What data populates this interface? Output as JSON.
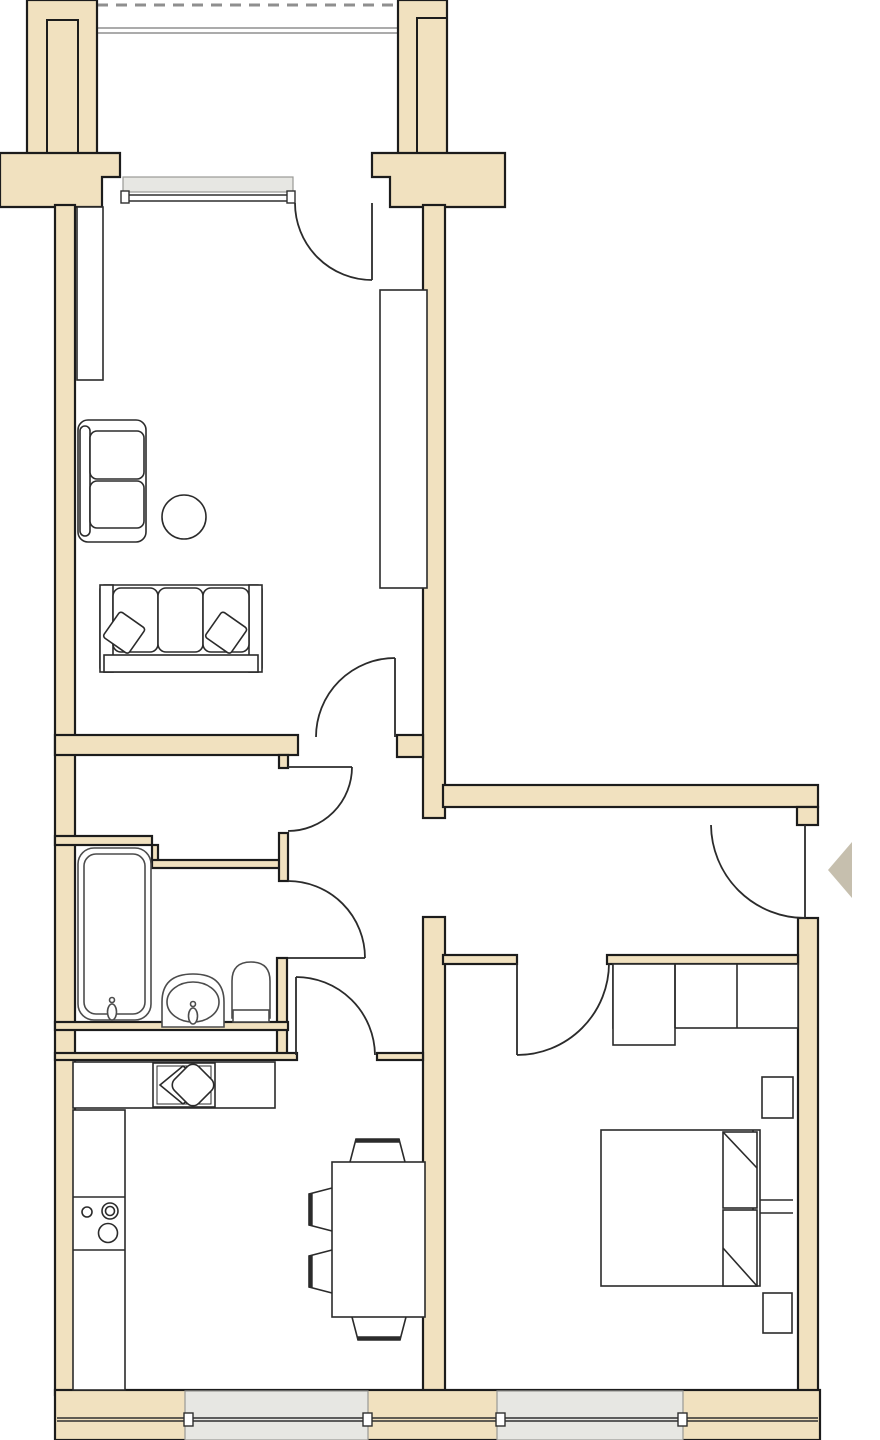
{
  "page": {
    "title": "apartment-floor-plan",
    "description": "architectural floor plan drawing, no text labels"
  },
  "colors": {
    "background": "#ffffff",
    "wall_fill": "#f1e1bf",
    "wall_outline": "#1c1c1c",
    "wall_inner_line": "#1c1c1c",
    "window_fill": "#e7e7e3",
    "window_stroke": "#9a9a96",
    "glazing_stroke": "#2f2f2f",
    "balcony_stroke": "#8f8f8f",
    "door_stroke": "#2b2b2b",
    "fixture_stroke": "#4c4c4c",
    "furniture_stroke": "#2b2b2b",
    "furniture_fill": "#ffffff",
    "entry_arrow_fill": "#c6bfae"
  },
  "rooms": {
    "balcony": {
      "features": [
        "dashed-edge-line",
        "railing-double-line"
      ]
    },
    "living_room": {
      "furniture": [
        "tall-cabinet",
        "loveseat",
        "round-side-table",
        "sofa-3-seat",
        "throw-pillow",
        "throw-pillow",
        "wardrobe"
      ]
    },
    "hall": {
      "features": [
        "inner-door",
        "open-passage"
      ]
    },
    "bathroom": {
      "fixtures": [
        "bathtub",
        "wash-basin",
        "toilet",
        "installation-shaft"
      ]
    },
    "kitchen_dining": {
      "furniture": [
        "counter-top",
        "kitchen-sink-unit",
        "stove-with-burners",
        "tall-counter-run",
        "dining-table",
        "chair",
        "chair",
        "chair",
        "chair"
      ]
    },
    "bedroom": {
      "furniture": [
        "closet-3-sections",
        "nightstand",
        "nightstand",
        "double-bed",
        "pillow",
        "pillow",
        "bedside-tray"
      ]
    }
  },
  "doors": [
    {
      "name": "balcony-door",
      "swing": "into-living-room"
    },
    {
      "name": "living-room-door",
      "swing": "into-living-room"
    },
    {
      "name": "hall-inner-door",
      "swing": "into-hall"
    },
    {
      "name": "bathroom-door",
      "swing": "into-hall"
    },
    {
      "name": "kitchen-door",
      "swing": "into-hall"
    },
    {
      "name": "bedroom-door",
      "swing": "into-bedroom"
    },
    {
      "name": "entry-door",
      "swing": "into-entry-hall"
    }
  ],
  "windows": [
    {
      "name": "living-room-window",
      "wall": "top"
    },
    {
      "name": "kitchen-window",
      "wall": "bottom"
    },
    {
      "name": "bedroom-window",
      "wall": "bottom"
    }
  ],
  "markers": [
    {
      "name": "entry-arrow",
      "direction": "left"
    }
  ]
}
